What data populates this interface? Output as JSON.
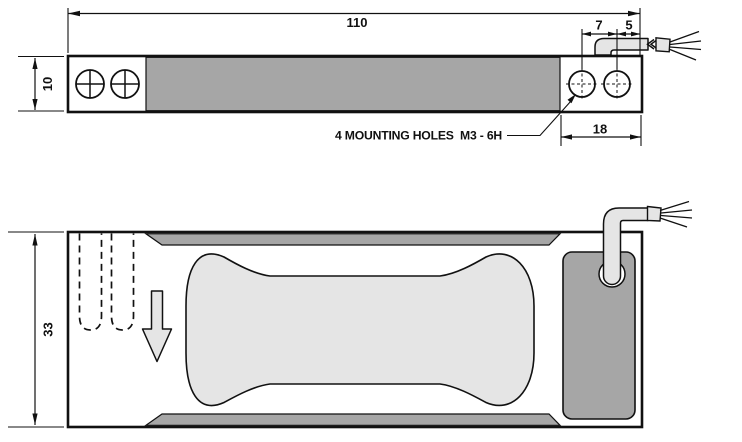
{
  "diagram": {
    "side_view": {
      "dim_overall_length": "110",
      "dim_height": "10",
      "dim_hole_pitch": "7",
      "dim_hole_to_end": "5",
      "dim_mount_block": "18",
      "mounting_note": "4 MOUNTING HOLES  M3 - 6H"
    },
    "plan_view": {
      "dim_width": "33"
    }
  },
  "colors": {
    "metal_gray": "#a6a6a6",
    "flexure_gray": "#e5e5e5",
    "line": "#111111",
    "paper": "#ffffff"
  }
}
